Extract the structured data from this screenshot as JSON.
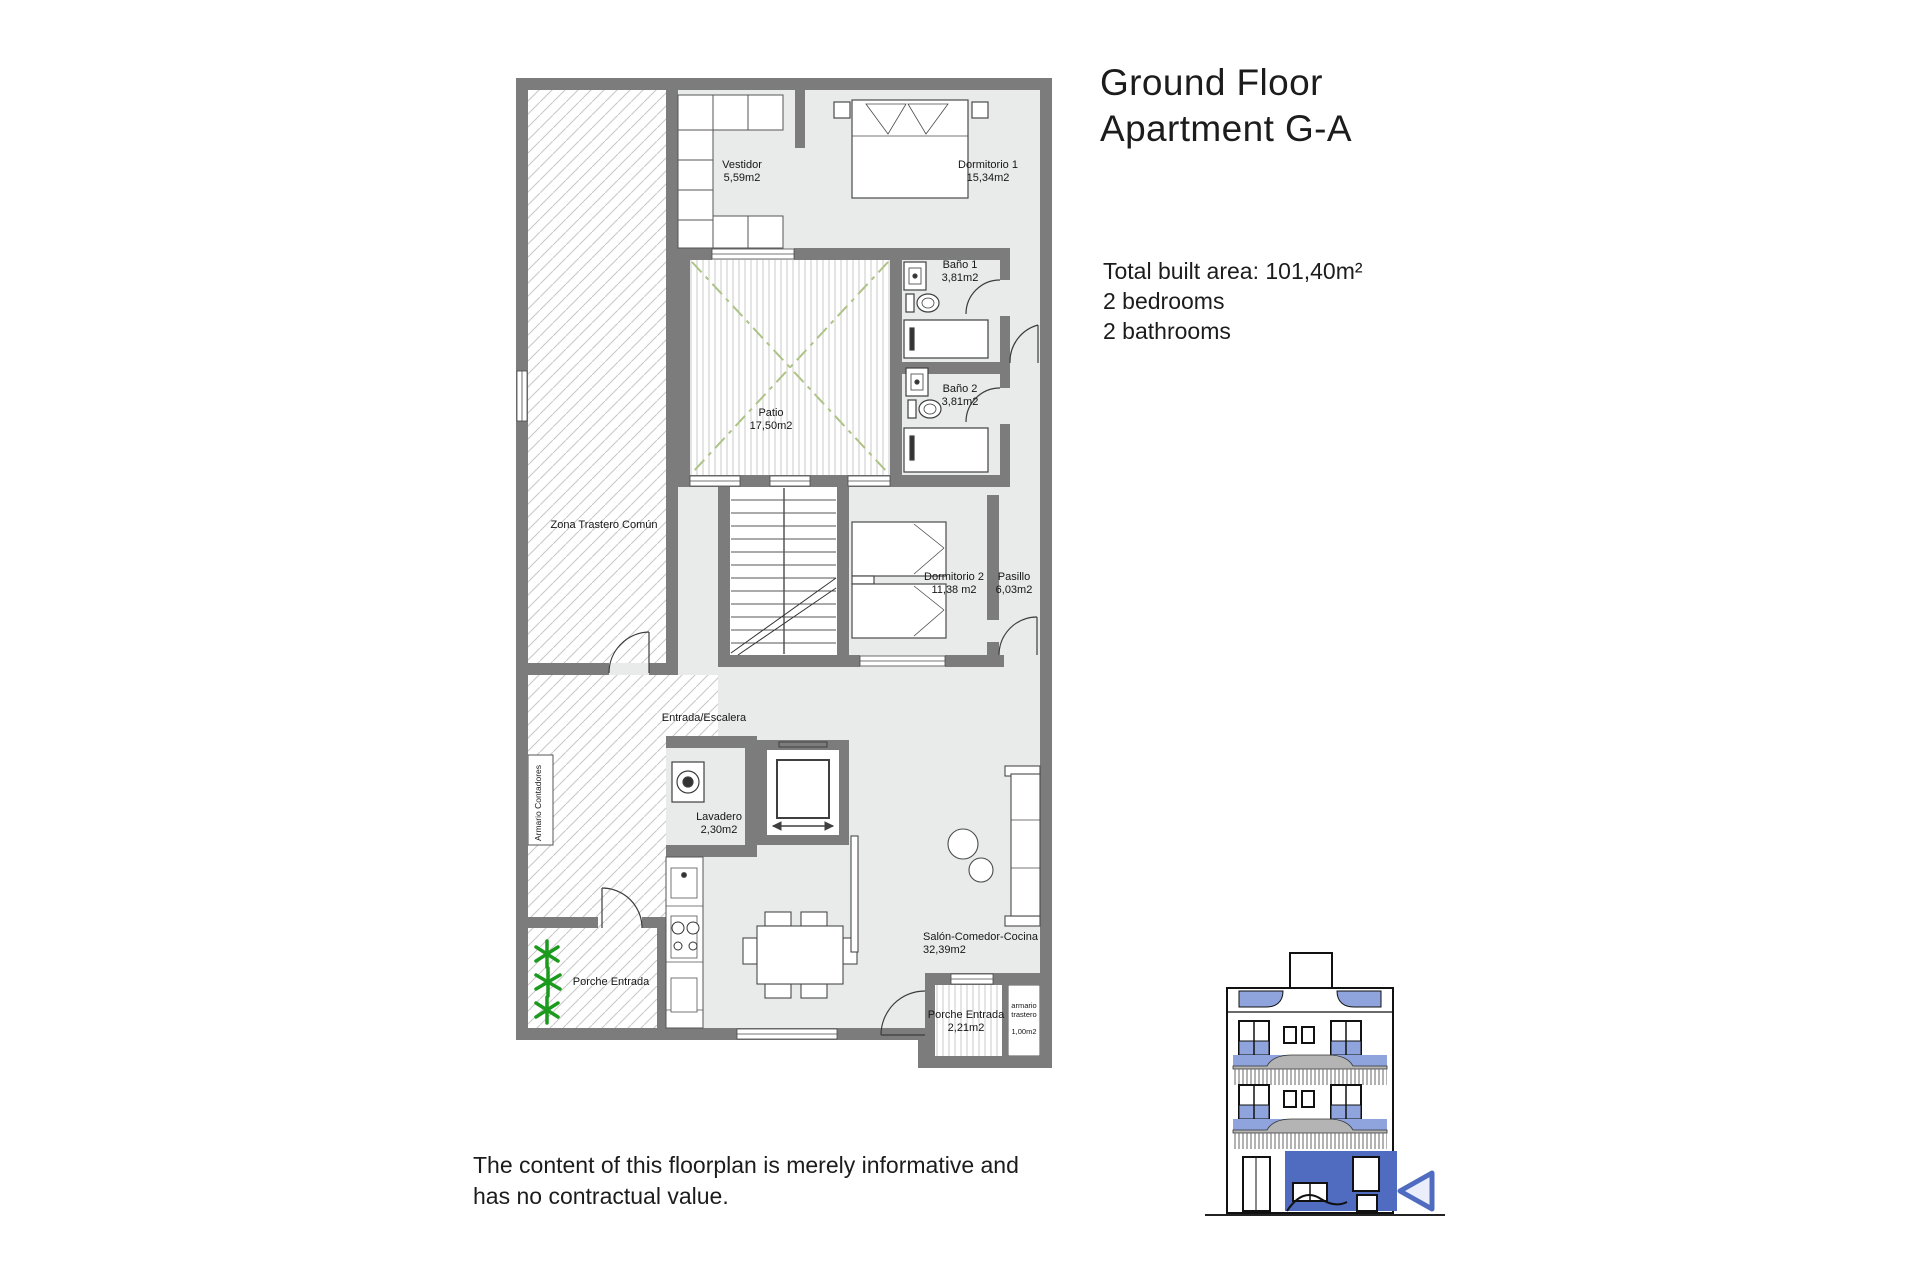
{
  "header": {
    "title_line1": "Ground Floor",
    "title_line2": "Apartment G-A"
  },
  "summary": {
    "total_area": "Total built area: 101,40m²",
    "bedrooms": "2 bedrooms",
    "bathrooms": "2 bathrooms"
  },
  "rooms": {
    "vestidor": {
      "name": "Vestidor",
      "area": "5,59m2"
    },
    "dormitorio1": {
      "name": "Dormitorio 1",
      "area": "15,34m2"
    },
    "bano1": {
      "name": "Baño 1",
      "area": "3,81m2"
    },
    "bano2": {
      "name": "Baño 2",
      "area": "3,81m2"
    },
    "patio": {
      "name": "Patio",
      "area": "17,50m2"
    },
    "zona_trastero": {
      "name": "Zona Trastero Común"
    },
    "dormitorio2": {
      "name": "Dormitorio 2",
      "area": "11,38 m2"
    },
    "pasillo": {
      "name": "Pasillo",
      "area": "6,03m2"
    },
    "entrada": {
      "name": "Entrada/Escalera"
    },
    "lavadero": {
      "name": "Lavadero",
      "area": "2,30m2"
    },
    "armario_contadores": {
      "name": "Armario Contadores"
    },
    "porche_izquierdo": {
      "name": "Porche Entrada"
    },
    "salon": {
      "name": "Salón-Comedor-Cocina",
      "area": "32,39m2"
    },
    "porche_entrada": {
      "name": "Porche Entrada",
      "area": "2,21m2"
    },
    "armario_trastero": {
      "name_line1": "armario",
      "name_line2": "trastero",
      "area": "1,00m2"
    }
  },
  "disclaimer": {
    "line1": "The content of this floorplan is merely informative and",
    "line2": "has no contractual value."
  },
  "colors": {
    "wall_gray": "#7c7c7c",
    "accent_blue": "#4f6cc0",
    "light_blue": "#8fa3dd",
    "patio_green": "#aec386",
    "plant_green": "#1c9a1e"
  }
}
